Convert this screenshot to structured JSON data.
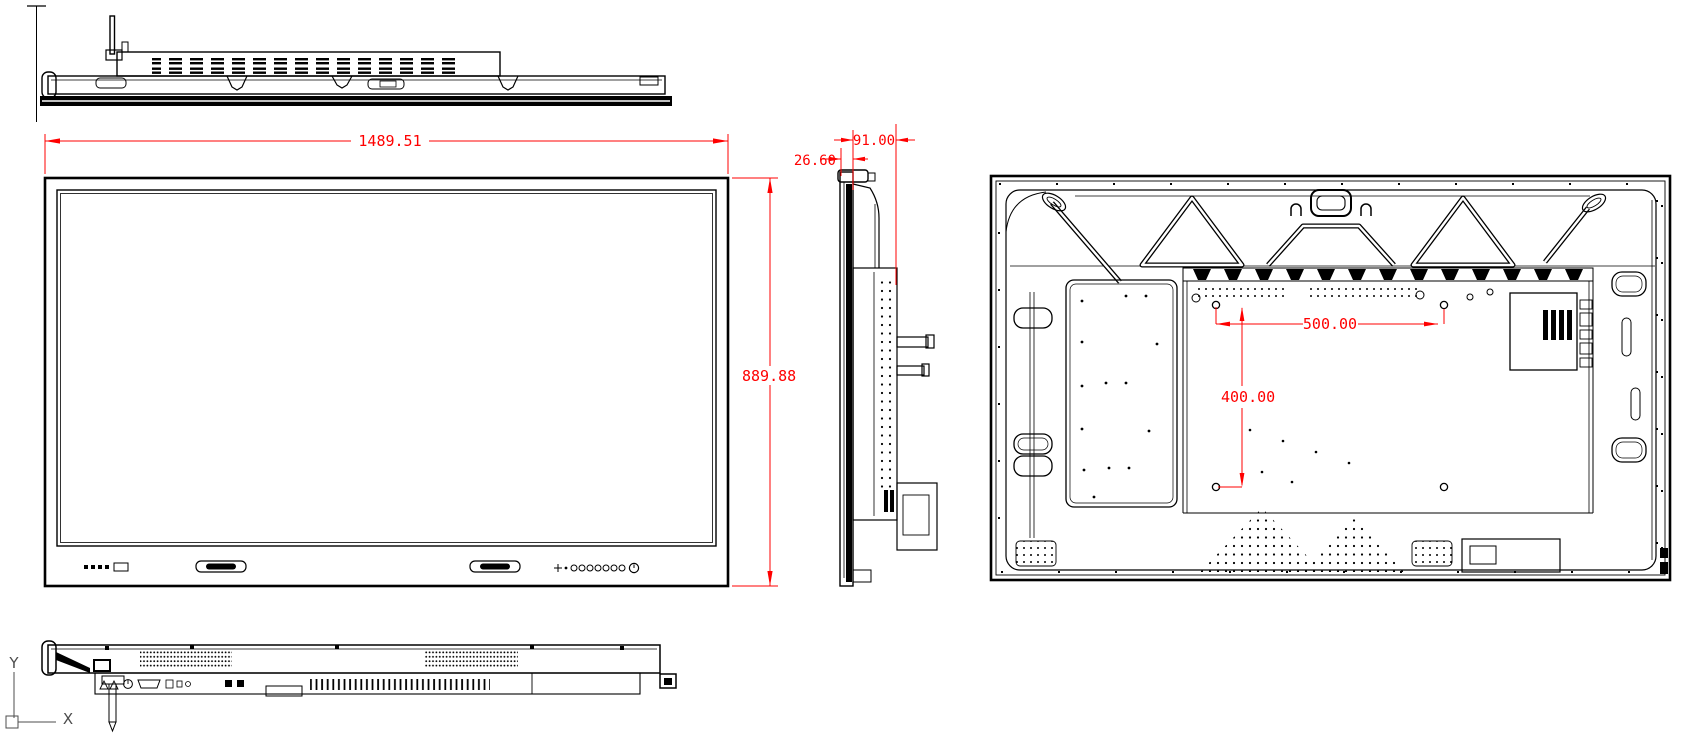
{
  "dimensions": {
    "front_width": "1489.51",
    "front_height": "889.88",
    "panel_depth": "26.60",
    "total_depth": "91.00",
    "vesa_width": "500.00",
    "vesa_height": "400.00"
  },
  "ucs": {
    "y_label": "Y",
    "x_label": "X"
  },
  "colors": {
    "dimension_red": "#ff0000",
    "line_black": "#000000",
    "background": "#ffffff"
  }
}
